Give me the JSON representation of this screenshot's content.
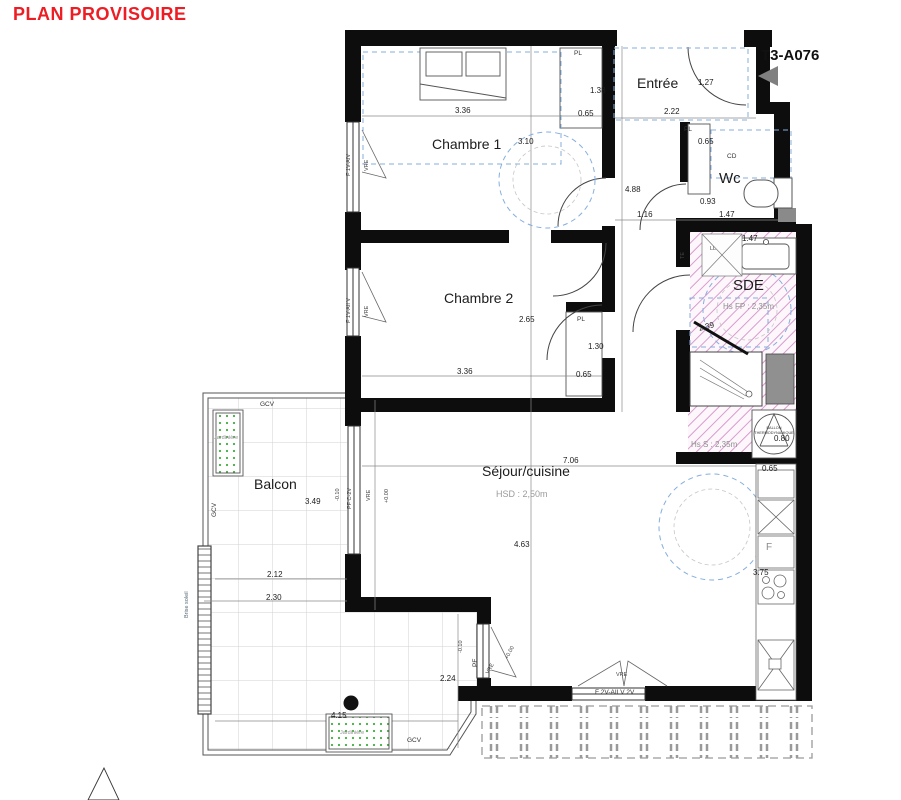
{
  "title": "PLAN PROVISOIRE",
  "unit_label": "T3-A076",
  "rooms": {
    "entree": "Entrée",
    "chambre1": "Chambre 1",
    "chambre2": "Chambre 2",
    "wc": "Wc",
    "sde": "SDE",
    "sejour": "Séjour/cuisine",
    "balcon": "Balcon"
  },
  "heights": {
    "sejour": "HSD : 2,50m",
    "sde_fp": "Hs FP : 2,35m",
    "sde_s": "Hs S : 2,35m"
  },
  "dims": {
    "d336": "3.36",
    "d310": "3.10",
    "d138": "1.38",
    "d065": "0.65",
    "d127": "1.27",
    "d222": "2.22",
    "d488": "4.88",
    "d116": "1.16",
    "d093": "0.93",
    "d147": "1.47",
    "d239": "2.39",
    "d080": "0.80",
    "d265": "2.65",
    "d130": "1.30",
    "d375": "3.75",
    "d706": "7.06",
    "d463": "4.63",
    "d349": "3.49",
    "d212": "2.12",
    "d230": "2.30",
    "d415": "4.15",
    "d224": "2.24",
    "lvl_m": "-0.10",
    "lvl_p": "+0.00"
  },
  "labels": {
    "pl": "PL",
    "cd": "CD",
    "gcv": "GCV",
    "vre": "VRE",
    "ll": "LL",
    "te": "TE",
    "fridge": "F",
    "jardiniere": "Jardinière",
    "brise_soleil": "Brise soleil",
    "win_ch1": "F 1V-AIV",
    "win_ch2": "F 1V-AII V",
    "win_sejour_w": "PF C-2V",
    "win_sejour_s": "PF",
    "win_bottom": "F 2V-AII V 2V",
    "ballon_l1": "BALLON",
    "ballon_l2": "THERMODYNAMIQUE"
  }
}
